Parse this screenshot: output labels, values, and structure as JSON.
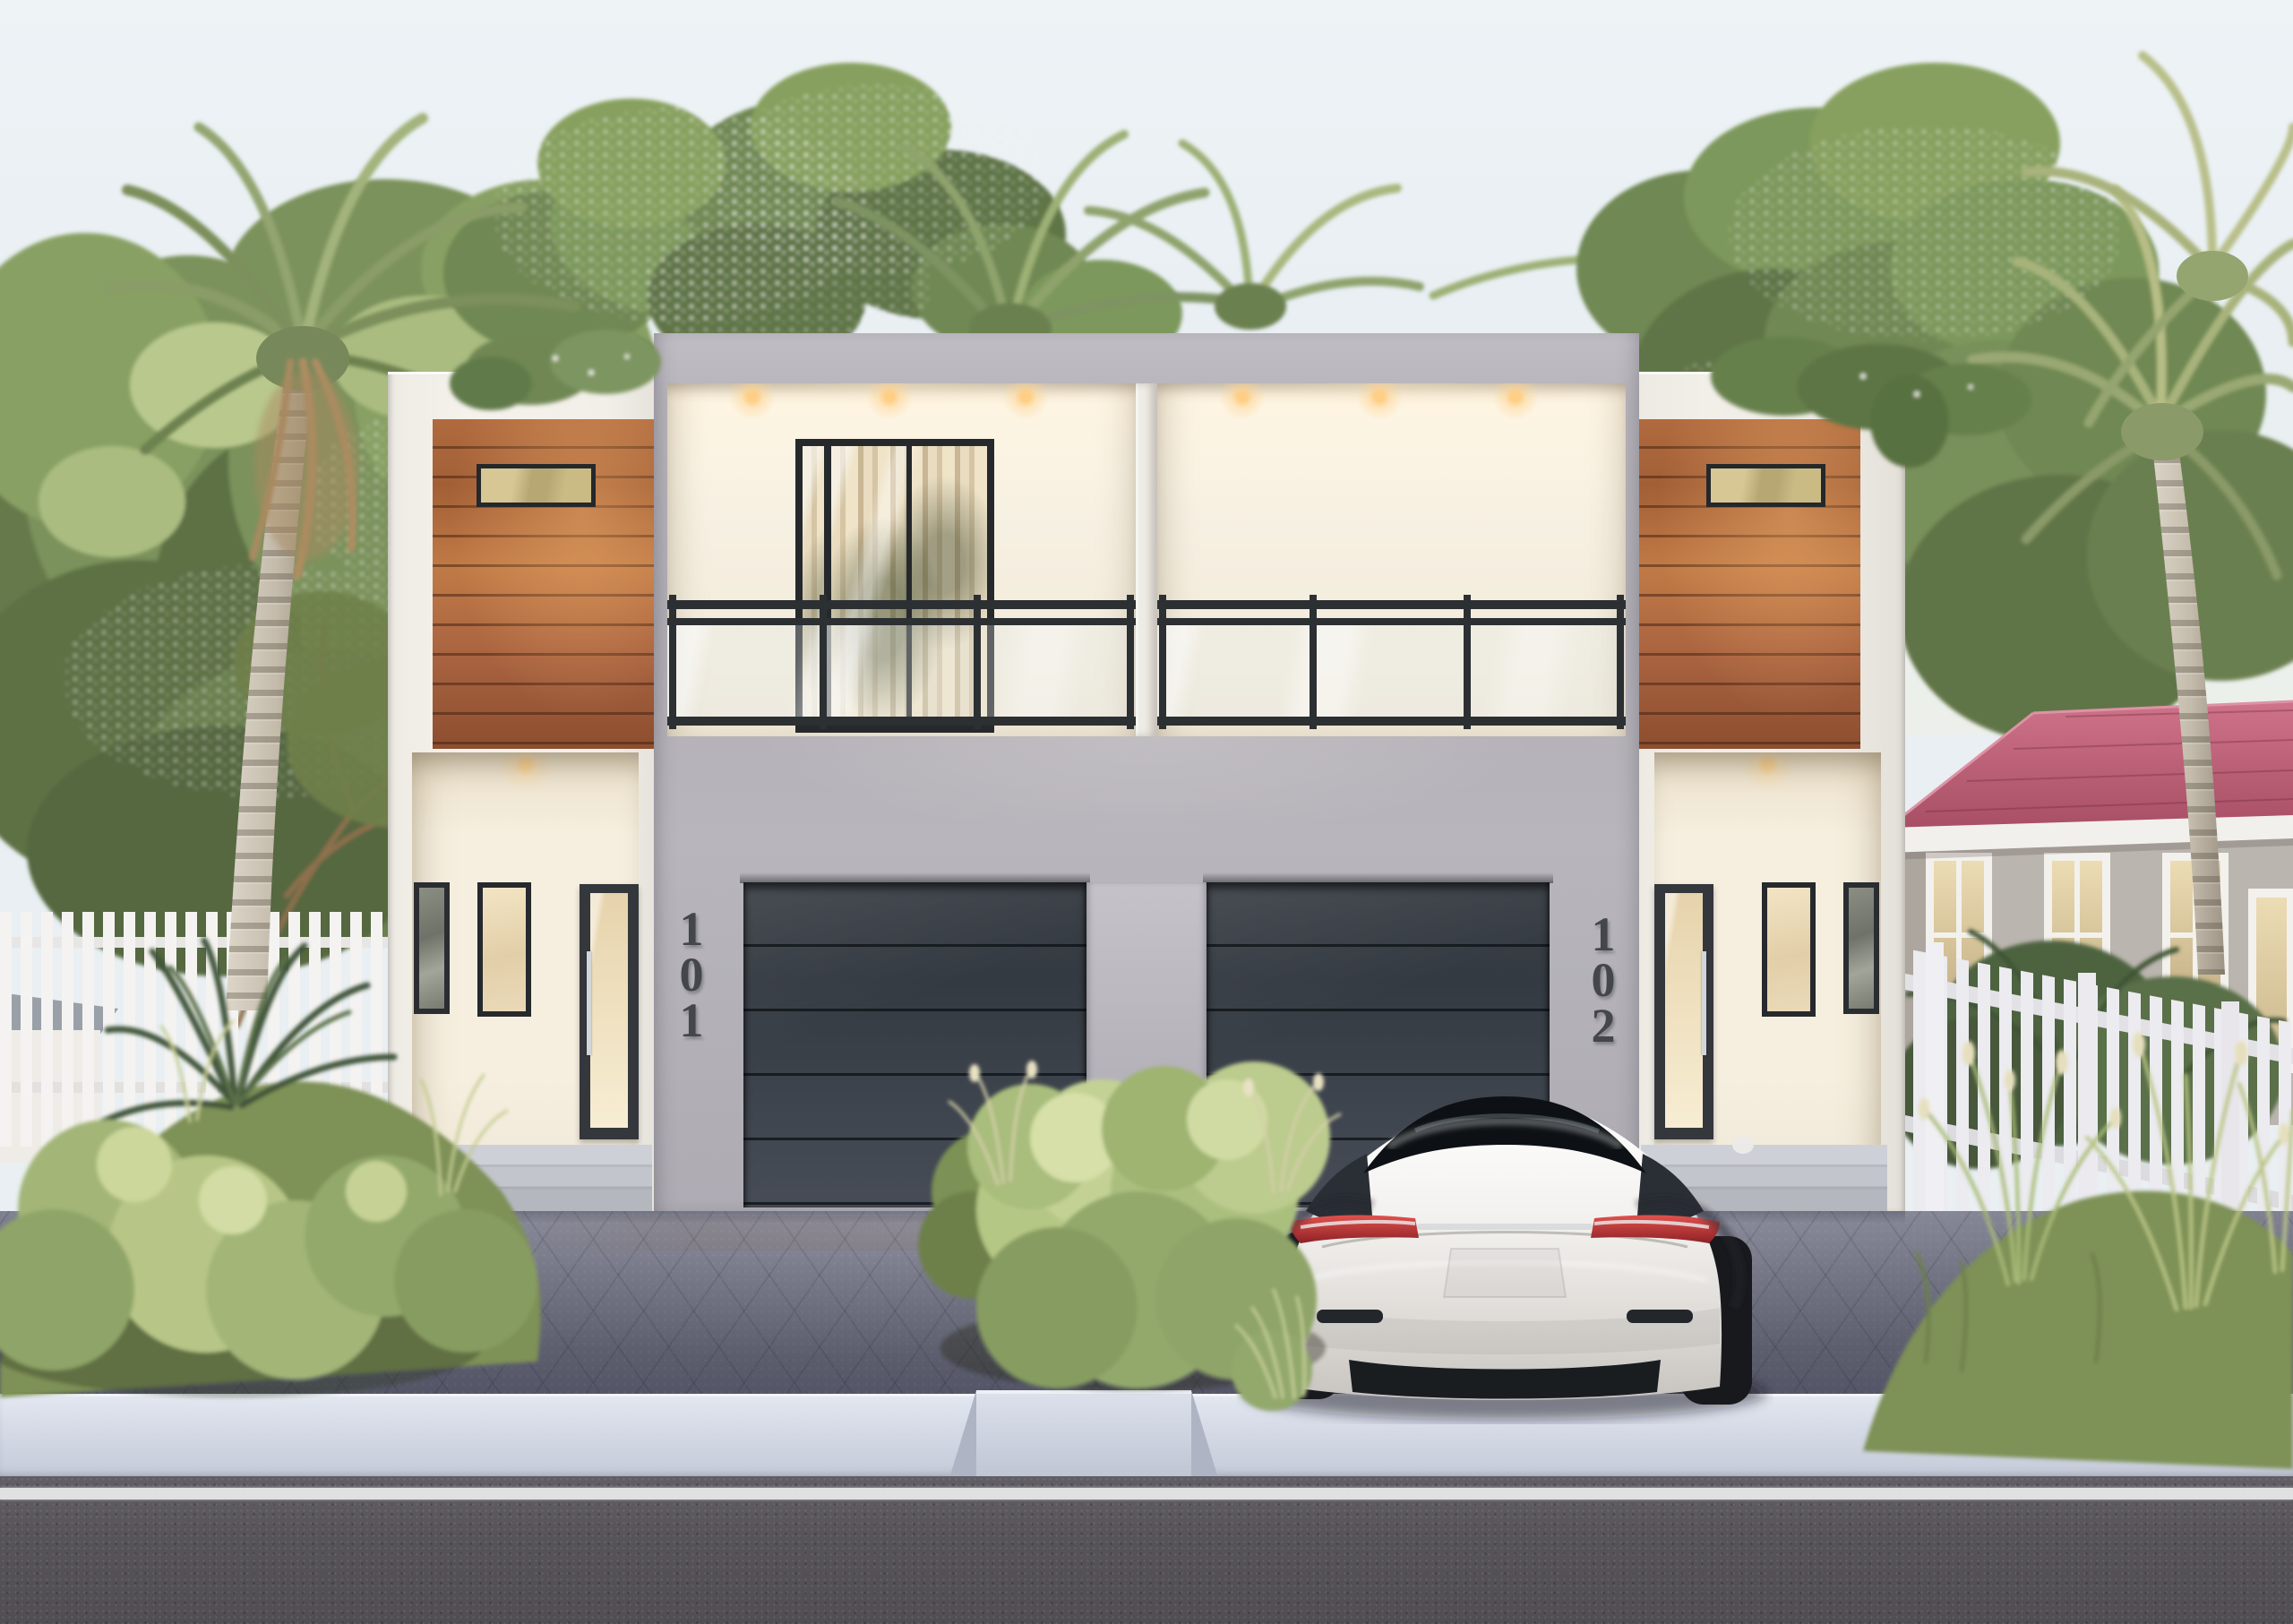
{
  "scene": {
    "description": "3D architectural rendering of a modern two-story duplex with wood accent panels, glass balconies, two garage doors, palm trees, tropical landscaping and a white sedan parked in the driveway",
    "sky_color": "#edf2f5",
    "facade_white": "#f3f0ea",
    "facade_gray": "#b6b3ba",
    "garage_door_color": "#3a4047",
    "wood_accent_color": "#a86a40",
    "balcony_railing_color": "#2c3033",
    "window_frame_color": "#26292c",
    "curtain_color": "#e9dcc0",
    "interior_light_color": "#ffd28a",
    "neighbor_roof_pink": "#bb5f77",
    "fence_color": "#f3f2f0",
    "driveway_color": "#757887",
    "sidewalk_color": "#d2d6e2",
    "road_color": "#57545a",
    "road_line_color": "#ececec",
    "car_color": "#f2f0ed",
    "car_taillight_color": "#c23636",
    "foliage_green": "#7d9258",
    "palm_trunk_color": "#c4bbab",
    "house_number_color": "#43464b"
  },
  "units": [
    {
      "number": "101"
    },
    {
      "number": "102"
    }
  ]
}
